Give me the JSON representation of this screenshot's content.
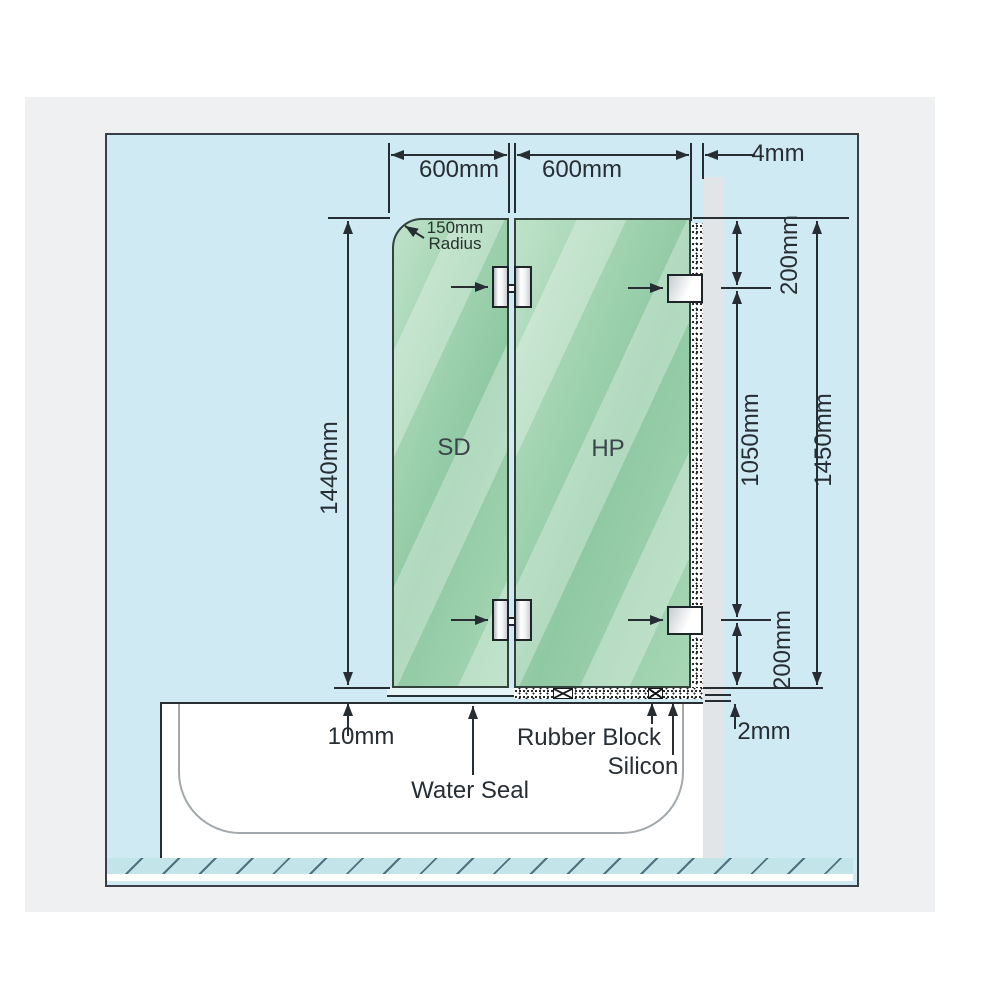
{
  "diagram": {
    "panels": {
      "shower_door_label": "SD",
      "hinged_panel_label": "HP"
    },
    "dimensions": {
      "sd_width": "600mm",
      "hp_width": "600mm",
      "wall_gap": "4mm",
      "corner_radius": "150mm",
      "corner_radius_word": "Radius",
      "sd_height": "1440mm",
      "top_bracket_offset": "200mm",
      "bracket_spacing": "1050mm",
      "overall_height": "1450mm",
      "bottom_bracket_offset": "200mm",
      "tub_clearance": "10mm",
      "bottom_edge_gap": "2mm"
    },
    "annotations": {
      "water_seal": "Water Seal",
      "rubber_block": "Rubber Block",
      "silicon": "Silicon"
    },
    "colors": {
      "canvas_blue": "#cfeaf3",
      "glass_green": "#9ed1af",
      "wall_gray": "#e2e5e7",
      "card_gray": "#eef0f2",
      "line_dark": "#262d33"
    }
  }
}
